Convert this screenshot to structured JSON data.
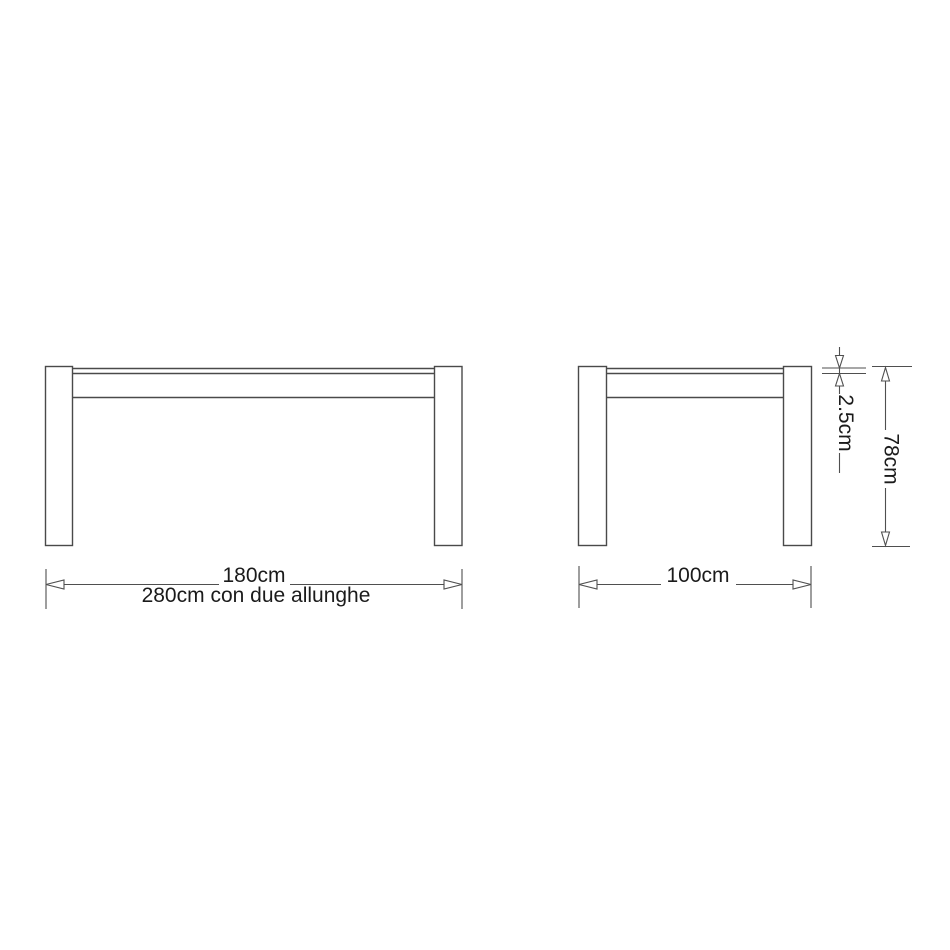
{
  "title": "Extendable table technical drawing",
  "colors": {
    "background": "#ffffff",
    "line": "#4a4a4a",
    "text": "#1b1b1b"
  },
  "dimensions": {
    "front_width": "180cm",
    "front_width_extended": "280cm con due allunghe",
    "side_depth": "100cm",
    "top_thickness": "2.5cm",
    "height": "78cm"
  }
}
